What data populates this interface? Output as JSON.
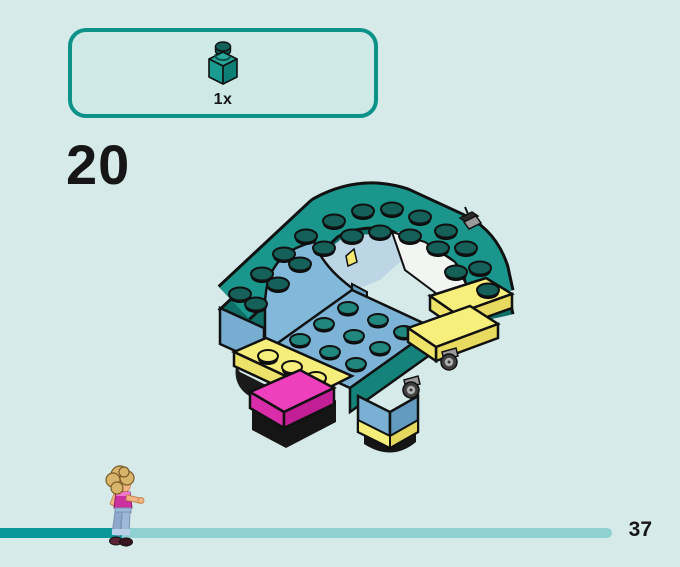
{
  "page": {
    "background_color": "#d6ebe9",
    "step_number": "20",
    "page_number": "37"
  },
  "parts_panel": {
    "count_label": "1x",
    "part": "teal-1x1-brick",
    "border_color": "#0c9289",
    "fill_color": "#cfe9e6",
    "brick_color": "#17968b"
  },
  "illustration": {
    "name": "lego-sofa-cart-assembly",
    "palette": {
      "teal": "#1b968c",
      "teal_dark": "#0f6f67",
      "stud_teal": "#15615a",
      "light_blue": "#7db3d6",
      "yellow": "#f7ef7c",
      "magenta": "#ee3fbd",
      "black": "#151515",
      "gray": "#9a9a9a",
      "white": "#f2f5f2"
    }
  },
  "progress": {
    "done_color": "#0a989a",
    "remaining_color": "#8fd0d2",
    "mascot": "mini-doll-mascot"
  }
}
